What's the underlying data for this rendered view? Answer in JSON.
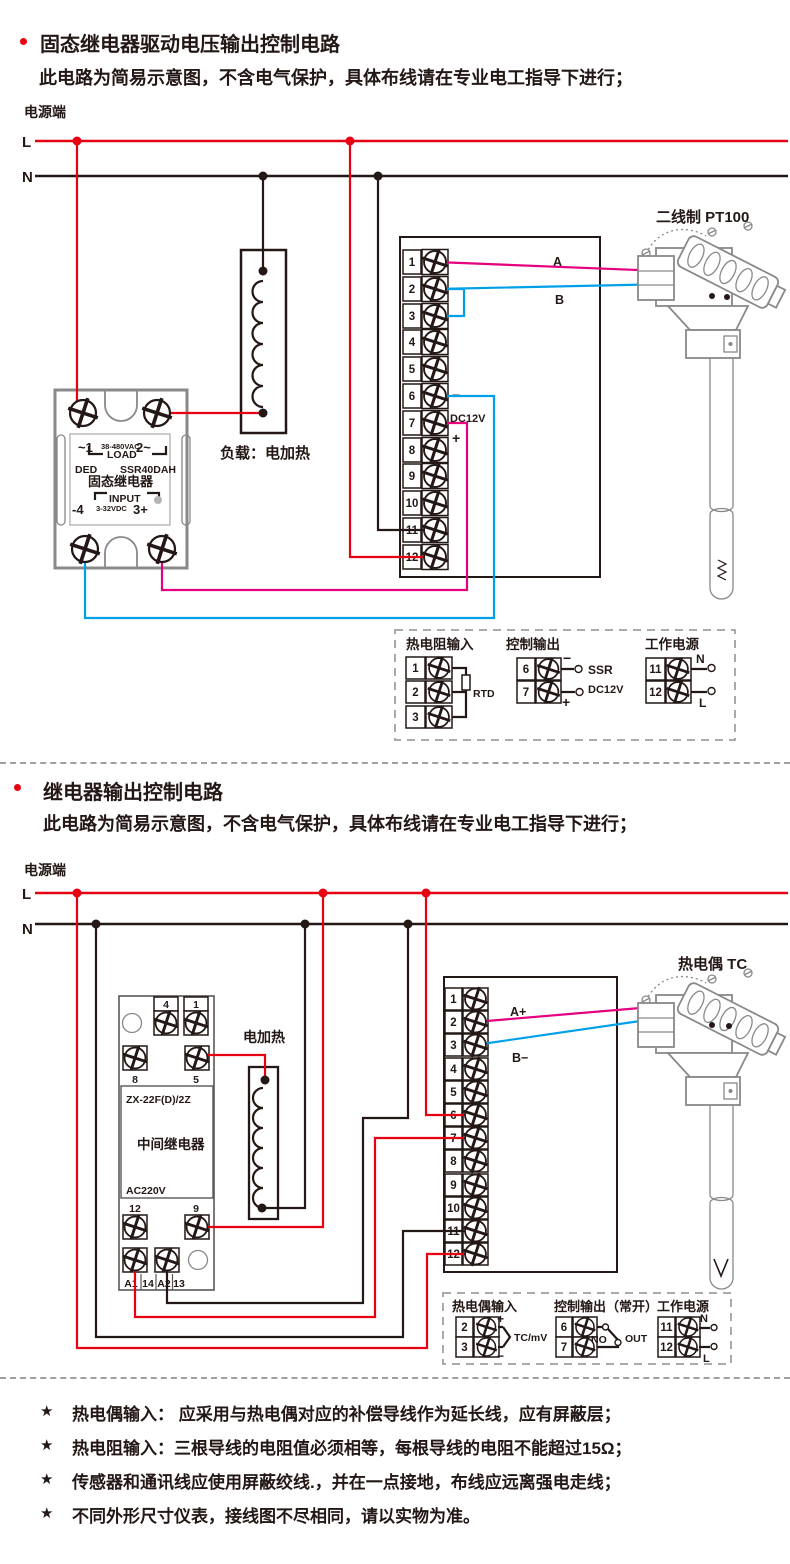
{
  "colors": {
    "line_red": "#e60012",
    "wire_pink": "#e4007f",
    "wire_blue": "#00a0e9",
    "line_black": "#231815",
    "component_gray": "#898989"
  },
  "section1": {
    "title": "固态继电器驱动电压输出控制电路",
    "subtitle": "此电路为简易示意图，不含电气保护，具体布线请在专业电工指导下进行；",
    "power_label": "电源端",
    "l": "L",
    "n": "N",
    "ssr": {
      "t1": "~1",
      "vac": "38-480VAC",
      "t2": "2~",
      "load": "LOAD",
      "brand": "DED",
      "model": "SSR40DAH",
      "name": "固态继电器",
      "input": "INPUT",
      "t4": "-4",
      "vdc": "3-32VDC",
      "t3": "3+"
    },
    "load_label": "负载：电加热",
    "terminals": [
      "1",
      "2",
      "3",
      "4",
      "5",
      "6",
      "7",
      "8",
      "9",
      "10",
      "11",
      "12"
    ],
    "wire_a": "A",
    "wire_b": "B",
    "minus": "−",
    "dc": "DC12V",
    "plus": "+",
    "sensor_label": "二线制 PT100",
    "legend": {
      "rtd_title": "热电阻输入",
      "rtd_terminals": [
        "1",
        "2",
        "3"
      ],
      "rtd": "RTD",
      "out_title": "控制输出",
      "out_terminals": [
        "6",
        "7"
      ],
      "out_minus": "−",
      "out_plus": "+",
      "out_ssr": "SSR",
      "out_dc": "DC12V",
      "pwr_title": "工作电源",
      "pwr_terminals": [
        "11",
        "12"
      ],
      "pwr_n": "N",
      "pwr_l": "L"
    }
  },
  "section2": {
    "title": "继电器输出控制电路",
    "subtitle": "此电路为简易示意图，不含电气保护，具体布线请在专业电工指导下进行；",
    "power_label": "电源端",
    "l": "L",
    "n": "N",
    "relay": {
      "top_left": "4",
      "top_right": "1",
      "mid_left": "8",
      "mid_right": "5",
      "model": "ZX-22F(D)/2Z",
      "name": "中间继电器",
      "voltage": "AC220V",
      "row3_left": "12",
      "row3_right": "9",
      "b1": "A1",
      "b2": "14",
      "b3": "A2",
      "b4": "13"
    },
    "heater_label": "电加热",
    "terminals": [
      "1",
      "2",
      "3",
      "4",
      "5",
      "6",
      "7",
      "8",
      "9",
      "10",
      "11",
      "12"
    ],
    "wire_a": "A+",
    "wire_b": "B−",
    "sensor_label": "热电偶 TC",
    "legend": {
      "tc_title": "热电偶输入",
      "tc_terminals": [
        "2",
        "3"
      ],
      "tc_plus": "+",
      "tc_minus": "−",
      "tc_label": "TC/mV",
      "out_title": "控制输出（常开）",
      "out_terminals": [
        "6",
        "7"
      ],
      "out_no": "NO",
      "out_out": "OUT",
      "pwr_title": "工作电源",
      "pwr_terminals": [
        "11",
        "12"
      ],
      "pwr_n": "N",
      "pwr_l": "L"
    }
  },
  "notes": {
    "star": "★",
    "items": [
      "热电偶输入： 应采用与热电偶对应的补偿导线作为延长线，应有屏蔽层；",
      "热电阻输入：三根导线的电阻值必须相等，每根导线的电阻不能超过15Ω；",
      "传感器和通讯线应使用屏蔽绞线.，并在一点接地，布线应远离强电走线；",
      "不同外形尺寸仪表，接线图不尽相同，请以实物为准。"
    ]
  }
}
